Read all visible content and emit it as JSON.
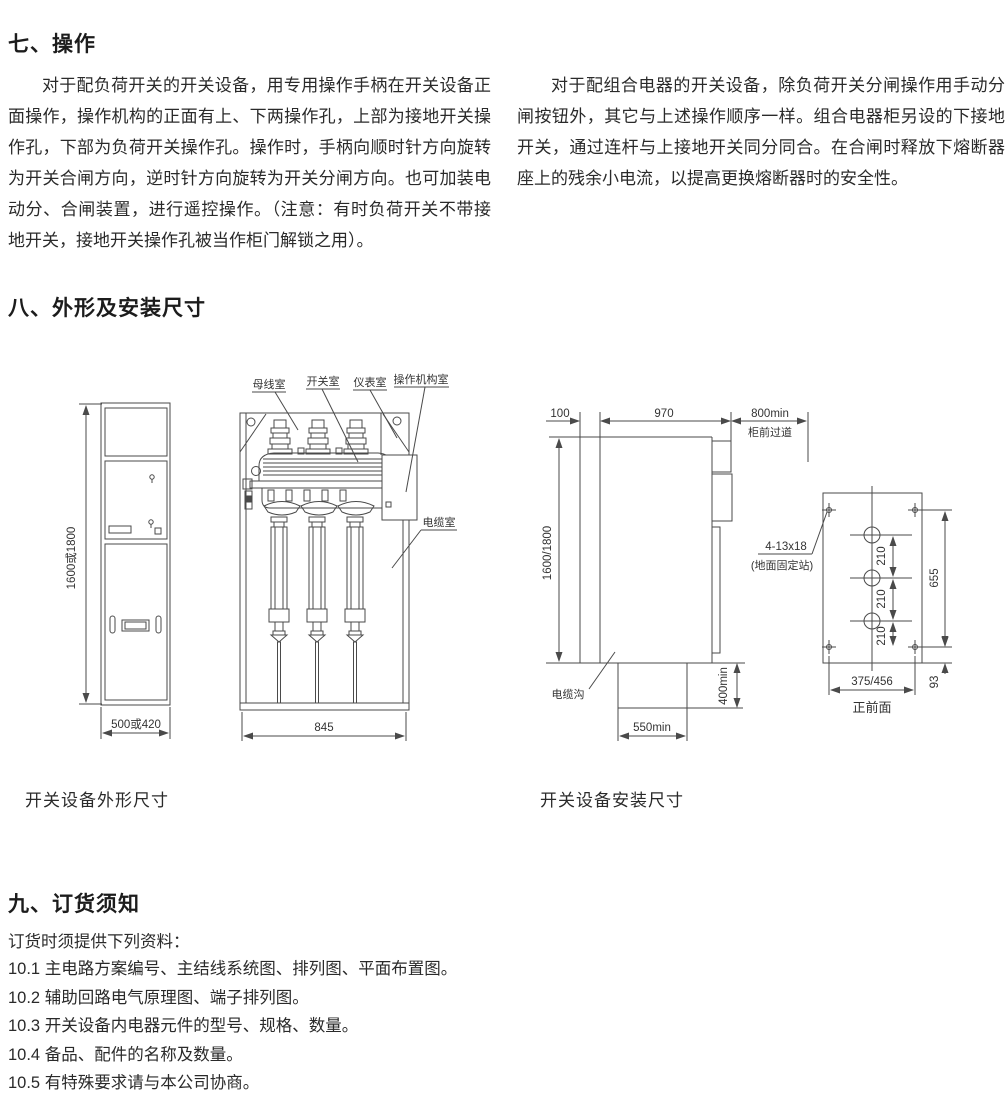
{
  "section_operation": {
    "title": "七、操作",
    "col_left": "对于配负荷开关的开关设备，用专用操作手柄在开关设备正面操作，操作机构的正面有上、下两操作孔，上部为接地开关操作孔，下部为负荷开关操作孔。操作时，手柄向顺时针方向旋转为开关合闸方向，逆时针方向旋转为开关分闸方向。也可加装电动分、合闸装置，进行遥控操作。（注意：有时负荷开关不带接地开关，接地开关操作孔被当作柜门解锁之用）。",
    "col_right": "对于配组合电器的开关设备，除负荷开关分闸操作用手动分闸按钮外，其它与上述操作顺序一样。组合电器柜另设的下接地开关，通过连杆与上接地开关同分同合。在合闸时释放下熔断器座上的残余小电流，以提高更换熔断器时的安全性。"
  },
  "section_dimensions": {
    "title": "八、外形及安装尺寸",
    "outline_caption": "开关设备外形尺寸",
    "install_caption": "开关设备安装尺寸",
    "front_view": {
      "height_label": "1600或1800",
      "width_label": "500或420"
    },
    "section_view": {
      "busbar_label": "母线室",
      "switch_label": "开关室",
      "instrument_label": "仪表室",
      "mechanism_label": "操作机构室",
      "cable_label": "电缆室",
      "width_label": "845"
    },
    "install_view": {
      "depth_gap": "100",
      "depth": "970",
      "aisle_min": "800min",
      "aisle_label": "柜前过道",
      "height_label": "1600/1800",
      "trench_label": "电缆沟",
      "trench_width": "550min",
      "trench_depth": "400min",
      "holes_label": "4-13x18",
      "holes_note": "(地面固定站)",
      "pitches": [
        "210",
        "210",
        "210"
      ],
      "span": "655",
      "offset": "93",
      "width_label": "375/456",
      "front_face_label": "正前面"
    }
  },
  "section_ordering": {
    "title": "九、订货须知",
    "intro": "订货时须提供下列资料：",
    "items": [
      "10.1 主电路方案编号、主结线系统图、排列图、平面布置图。",
      "10.2 辅助回路电气原理图、端子排列图。",
      "10.3 开关设备内电器元件的型号、规格、数量。",
      "10.4 备品、配件的名称及数量。",
      "10.5 有特殊要求请与本公司协商。"
    ]
  }
}
